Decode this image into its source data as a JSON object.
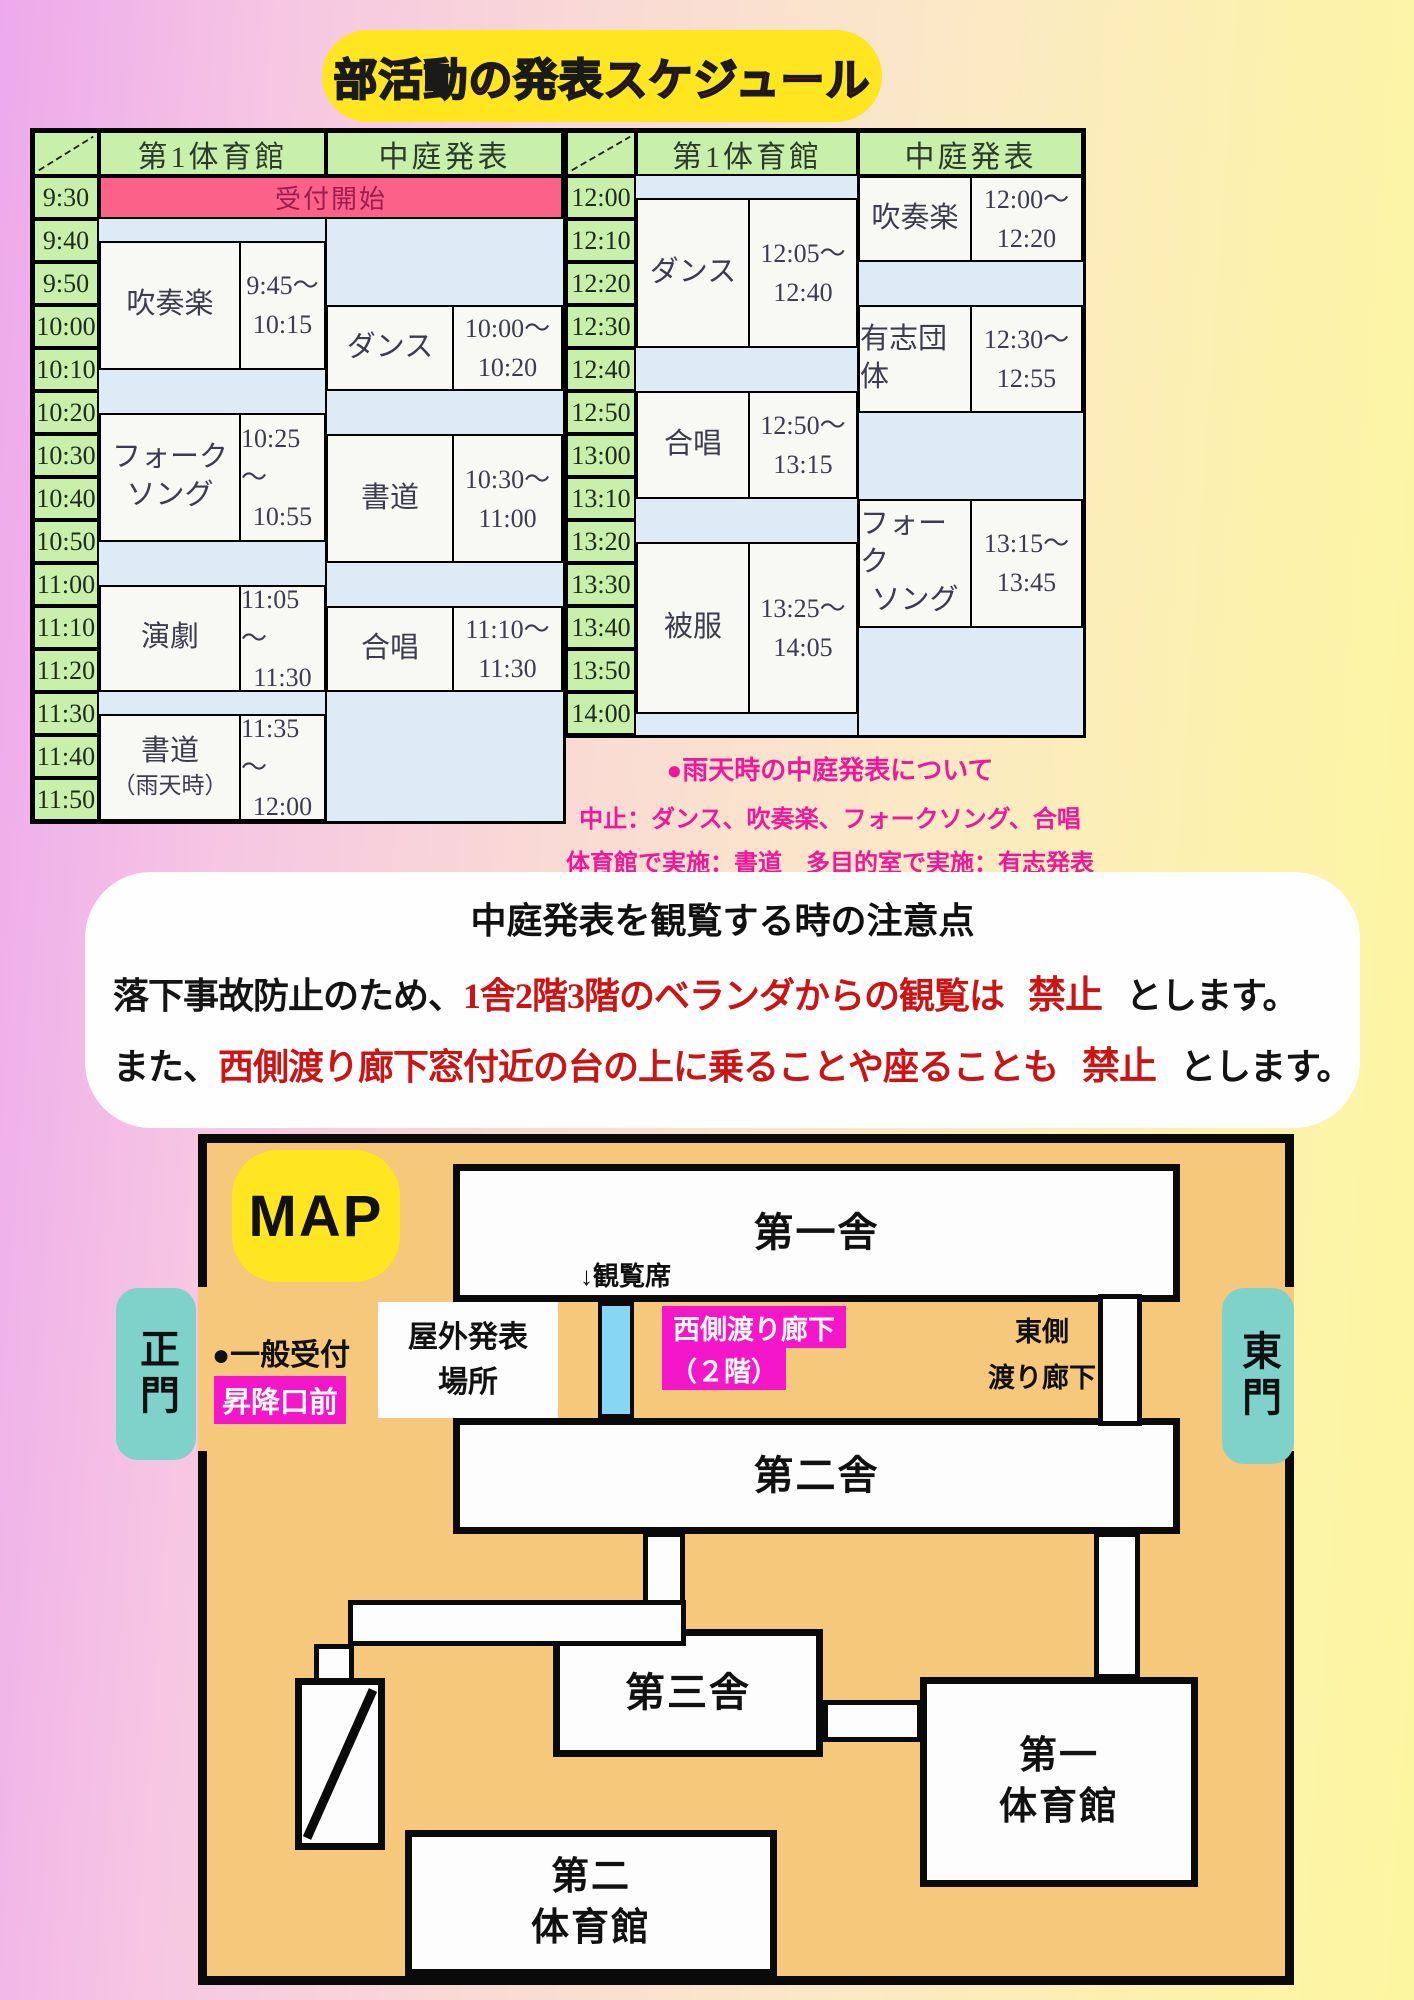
{
  "title": "部活動の発表スケジュール",
  "colors": {
    "title_red": "#e4002c",
    "title_bg": "#ffe620",
    "header_green": "#c8f0ab",
    "reception_pink": "#fb6189",
    "gap_blue": "#dcebf6",
    "note_pink": "#ef189b",
    "ban_red": "#cc1414",
    "map_orange": "#f6c87c",
    "gate_teal": "#7fd2ca",
    "magenta": "#f417c9",
    "seats_blue": "#85d7f3"
  },
  "tables": [
    {
      "header_col1": "第1体育館",
      "header_col2": "中庭発表",
      "reception": "受付開始",
      "times": [
        "9:30",
        "9:40",
        "9:50",
        "10:00",
        "10:10",
        "10:20",
        "10:30",
        "10:40",
        "10:50",
        "11:00",
        "11:10",
        "11:20",
        "11:30",
        "11:40",
        "11:50"
      ],
      "col1_events": [
        {
          "name_lines": [
            "吹奏楽"
          ],
          "start": "9:45",
          "end": "10:15",
          "time_lines": [
            "9:45～",
            "10:15"
          ]
        },
        {
          "name_lines": [
            "フォーク",
            "ソング"
          ],
          "start": "10:25",
          "end": "10:55",
          "time_lines": [
            "10:25～",
            "10:55"
          ]
        },
        {
          "name_lines": [
            "演劇"
          ],
          "start": "11:05",
          "end": "11:30",
          "time_lines": [
            "11:05～",
            "11:30"
          ]
        },
        {
          "name_lines": [
            "書道",
            "（雨天時）"
          ],
          "start": "11:35",
          "end": "12:00",
          "time_lines": [
            "11:35～",
            "12:00"
          ]
        }
      ],
      "col2_events": [
        {
          "name_lines": [
            "ダンス"
          ],
          "start": "10:00",
          "end": "10:20",
          "time_lines": [
            "10:00～",
            "10:20"
          ]
        },
        {
          "name_lines": [
            "書道"
          ],
          "start": "10:30",
          "end": "11:00",
          "time_lines": [
            "10:30～",
            "11:00"
          ]
        },
        {
          "name_lines": [
            "合唱"
          ],
          "start": "11:10",
          "end": "11:30",
          "time_lines": [
            "11:10～",
            "11:30"
          ]
        }
      ]
    },
    {
      "header_col1": "第1体育館",
      "header_col2": "中庭発表",
      "reception": null,
      "times": [
        "12:00",
        "12:10",
        "12:20",
        "12:30",
        "12:40",
        "12:50",
        "13:00",
        "13:10",
        "13:20",
        "13:30",
        "13:40",
        "13:50",
        "14:00"
      ],
      "col1_events": [
        {
          "name_lines": [
            "ダンス"
          ],
          "start": "12:05",
          "end": "12:40",
          "time_lines": [
            "12:05～",
            "12:40"
          ]
        },
        {
          "name_lines": [
            "合唱"
          ],
          "start": "12:50",
          "end": "13:15",
          "time_lines": [
            "12:50～",
            "13:15"
          ]
        },
        {
          "name_lines": [
            "被服"
          ],
          "start": "13:25",
          "end": "14:05",
          "time_lines": [
            "13:25～",
            "14:05"
          ]
        }
      ],
      "col2_events": [
        {
          "name_lines": [
            "吹奏楽"
          ],
          "start": "12:00",
          "end": "12:20",
          "time_lines": [
            "12:00～",
            "12:20"
          ]
        },
        {
          "name_lines": [
            "有志団体"
          ],
          "start": "12:30",
          "end": "12:55",
          "time_lines": [
            "12:30～",
            "12:55"
          ]
        },
        {
          "name_lines": [
            "フォーク",
            "ソング"
          ],
          "start": "13:15",
          "end": "13:45",
          "time_lines": [
            "13:15～",
            "13:45"
          ]
        }
      ]
    }
  ],
  "rain_note": {
    "heading": "●雨天時の中庭発表について",
    "line1": "中止：ダンス、吹奏楽、フォークソング、合唱",
    "line2": "体育館で実施：書道　多目的室で実施：有志発表"
  },
  "notice": {
    "title": "中庭発表を観覧する時の注意点",
    "line1_black": "落下事故防止のため、",
    "line1_red": "1舎2階3階のベランダからの観覧は",
    "line1_ban": "禁止",
    "line1_end": "とします。",
    "line2_black": "また、",
    "line2_red": "西側渡り廊下窓付近の台の上に乗ることや座ることも",
    "line2_ban": "禁止",
    "line2_end": "とします。"
  },
  "map": {
    "title": "MAP",
    "west_gate": "正門",
    "east_gate": "東門",
    "building1": "第一舎",
    "building2": "第二舎",
    "building3": "第三舎",
    "gym1_line1": "第一",
    "gym1_line2": "体育館",
    "gym2_line1": "第二",
    "gym2_line2": "体育館",
    "reception": "●一般受付",
    "reception_place": "昇降口前",
    "outdoor_line1": "屋外発表",
    "outdoor_line2": "場所",
    "seats": "↓観覧席",
    "west_corridor_line1": "西側渡り廊下",
    "west_corridor_line2": "（２階）",
    "east_corridor_line1": "東側",
    "east_corridor_line2": "渡り廊下"
  }
}
